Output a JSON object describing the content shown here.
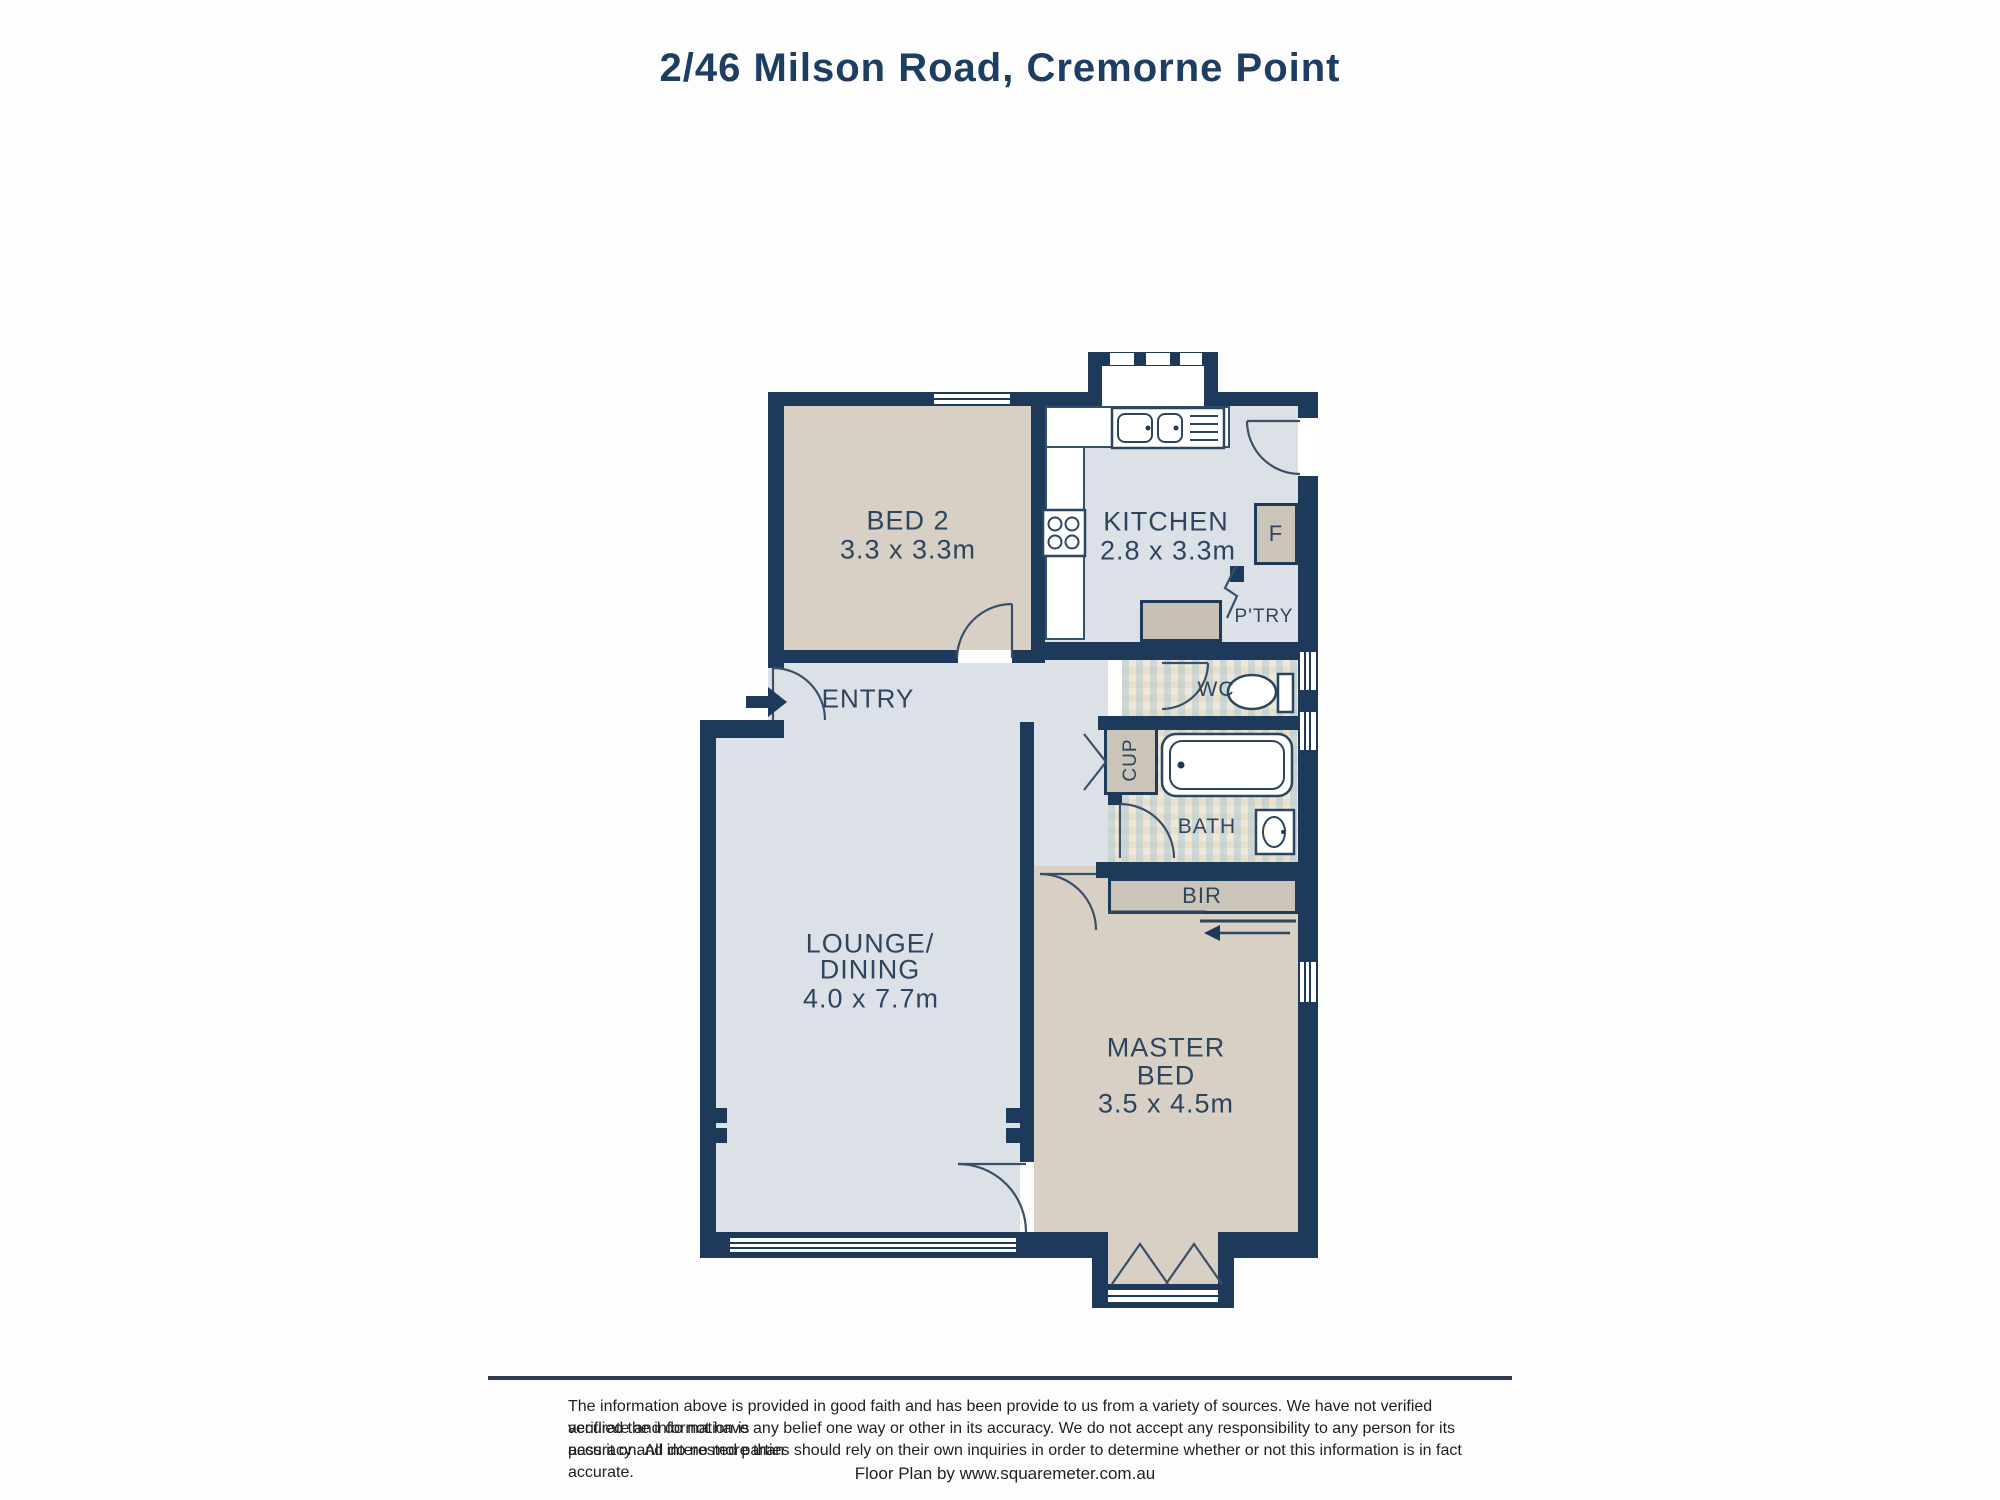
{
  "title": "2/46 Milson Road, Cremorne Point",
  "rooms": {
    "bed2": {
      "name": "BED 2",
      "dims": "3.3 x 3.3m"
    },
    "kitchen": {
      "name": "KITCHEN",
      "dims": "2.8 x 3.3m"
    },
    "entry": {
      "name": "ENTRY"
    },
    "lounge": {
      "name_line1": "LOUNGE/",
      "name_line2": "DINING",
      "dims": "4.0 x 7.7m"
    },
    "master": {
      "name_line1": "MASTER",
      "name_line2": "BED",
      "dims": "3.5 x 4.5m"
    }
  },
  "labels": {
    "wc": "WC",
    "bath": "BATH",
    "bir": "BIR",
    "cup": "CUP",
    "pantry": "P'TRY",
    "fridge": "F"
  },
  "footer": {
    "disclaimer_lines": [
      "The information above is provided in good faith and has been provide to us from a variety of sources. We have not verified veriflied the information is",
      "accurate and do not have any belief one way or other in its accuracy. We do not accept any responsibility to any person for its accuracy and do no more than",
      "pass it on. All interested parties should rely on their own inquiries in order to determine whether or not this information is in fact accurate."
    ],
    "credit": "Floor Plan by www.squaremeter.com.au"
  },
  "colors": {
    "wall": "#1e3a5a",
    "floor_grey": "#dce1e8",
    "floor_beige": "#d8d0c4",
    "closet": "#cbc4b9",
    "bench": "#c6c0b5",
    "tile_base": "#efe8d9",
    "fixture_line": "#2e4560",
    "label": "#2e4560",
    "title": "#1d3d63",
    "text": "#1f1f1f"
  }
}
